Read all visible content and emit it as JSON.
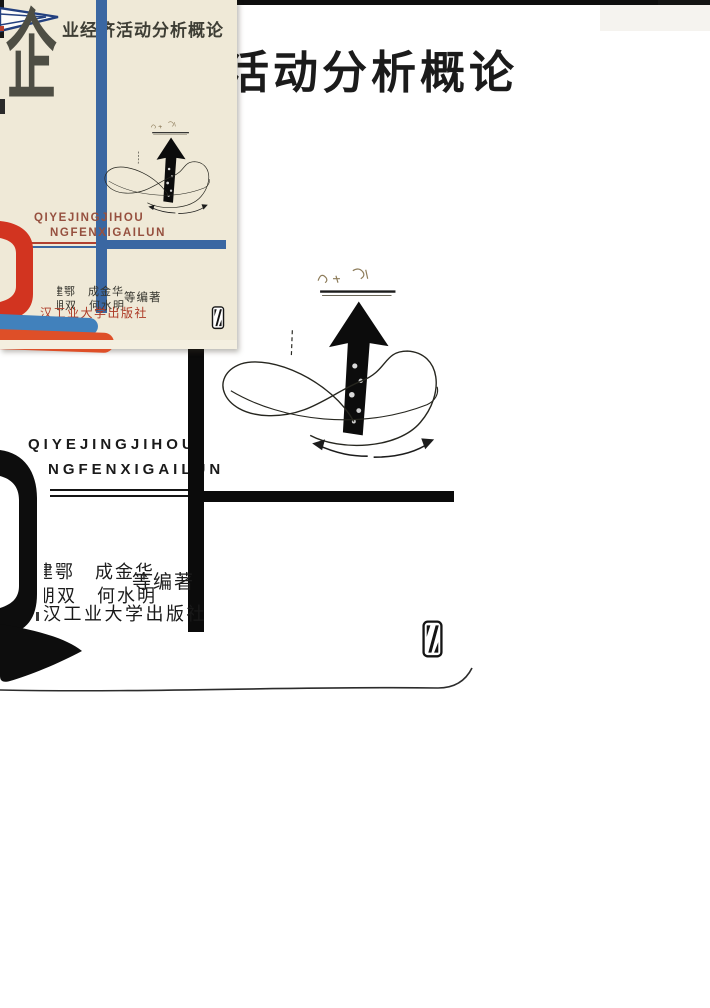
{
  "scan": {
    "title": "活动分析概论",
    "pinyin_line1": "QIYEJINGJIHOU",
    "pinyin_line2": "NGFENXIGAILUN",
    "authors_line1": "建鄂　成金华",
    "authors_line2": "朋双　何水明",
    "authors_suffix": "等编著",
    "publisher": "汉工业大学出版社",
    "ink_color": "#111111"
  },
  "thumbnail": {
    "big_char": "企",
    "title": "业经济活动分析概论",
    "pinyin_line1": "QIYEJINGJIHOU",
    "pinyin_line2": "NGFENXIGAILUN",
    "authors_line1": "建鄂　成金华",
    "authors_line2": "朋双　何水明",
    "authors_suffix": "等编著",
    "publisher": "汉工业大学出版社",
    "colors": {
      "cream": "#efe9d7",
      "blue": "#3a67a2",
      "light_blue_bar": "#4181bc",
      "red_ring": "#d23420",
      "orange_bar": "#de4f28",
      "pinyin_red": "#96503f",
      "publisher_red": "#ad3a26",
      "ink": "#4e4e44"
    }
  }
}
